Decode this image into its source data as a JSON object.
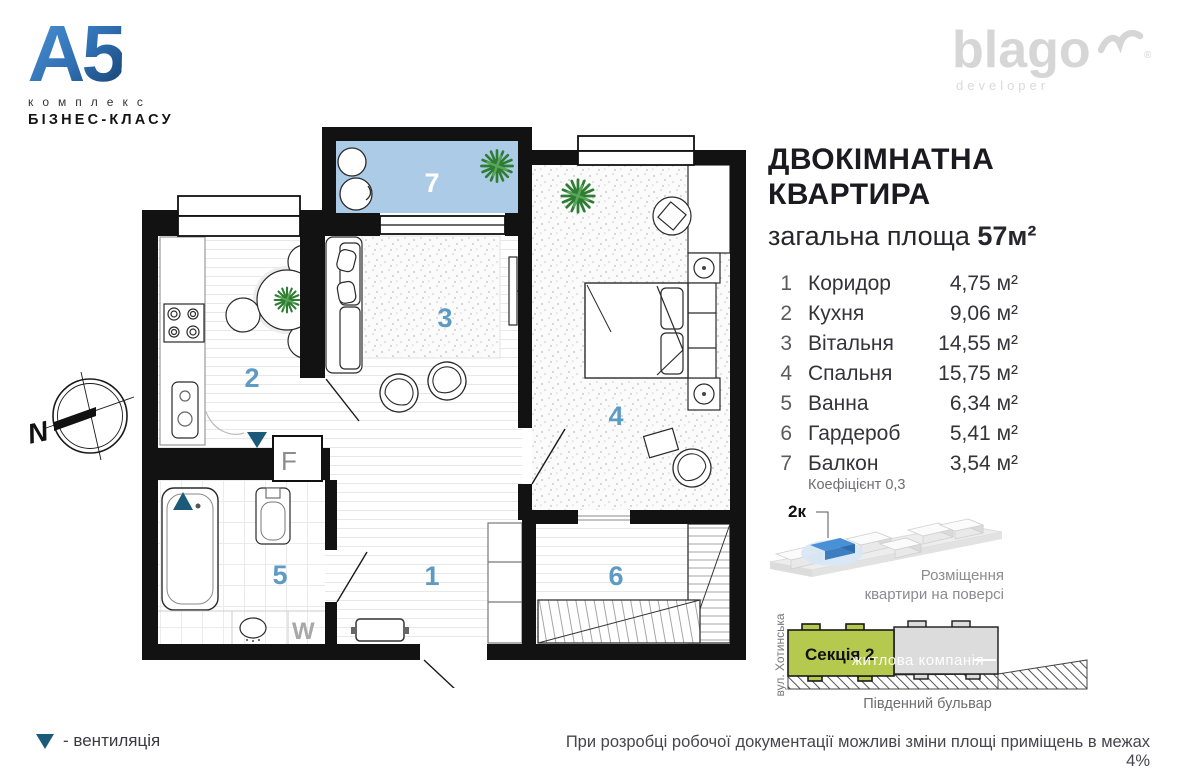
{
  "branding": {
    "logo_main": "А5",
    "logo_sub1": "комплекс",
    "logo_sub2": "БІЗНЕС-КЛАСУ",
    "developer": "blago",
    "developer_sub": "developer"
  },
  "title": {
    "line1": "ДВОКІМНАТНА",
    "line2": "КВАРТИРА",
    "area_label": "загальна площа",
    "area_value": "57м²"
  },
  "rooms": [
    {
      "num": "1",
      "name": "Коридор",
      "area": "4,75 м²"
    },
    {
      "num": "2",
      "name": "Кухня",
      "area": "9,06 м²"
    },
    {
      "num": "3",
      "name": "Вітальня",
      "area": "14,55 м²"
    },
    {
      "num": "4",
      "name": "Спальня",
      "area": "15,75 м²"
    },
    {
      "num": "5",
      "name": "Ванна",
      "area": "6,34 м²"
    },
    {
      "num": "6",
      "name": "Гардероб",
      "area": "5,41 м²"
    },
    {
      "num": "7",
      "name": "Балкон",
      "area": "3,54 м²"
    }
  ],
  "coefficient_note": "Коефіцієнт 0,3",
  "floor_diagram": {
    "unit_label": "2к",
    "caption_line1": "Розміщення",
    "caption_line2": "квартири на поверсі"
  },
  "site_diagram": {
    "section_label": "Секція 2",
    "watermark": "житлова компанія",
    "street_side": "вул. Хотинська",
    "street_bottom": "Південний бульвар"
  },
  "plan": {
    "numbers": [
      "1",
      "2",
      "3",
      "4",
      "5",
      "6",
      "7"
    ],
    "fridge_label": "F",
    "washer_label": "W",
    "compass_label": "N"
  },
  "legend": {
    "vent_label": "- вентиляція"
  },
  "disclaimer": "При розробці робочої документації можливі зміни площі приміщень в межах 4%",
  "colors": {
    "accent_number": "#5d9bc4",
    "balcony_floor": "#abcbe7",
    "vent": "#1b5a78",
    "section_green": "#b5c94f",
    "logo_blue": "#2f6fb2",
    "developer_gray": "#d6d6d6"
  }
}
